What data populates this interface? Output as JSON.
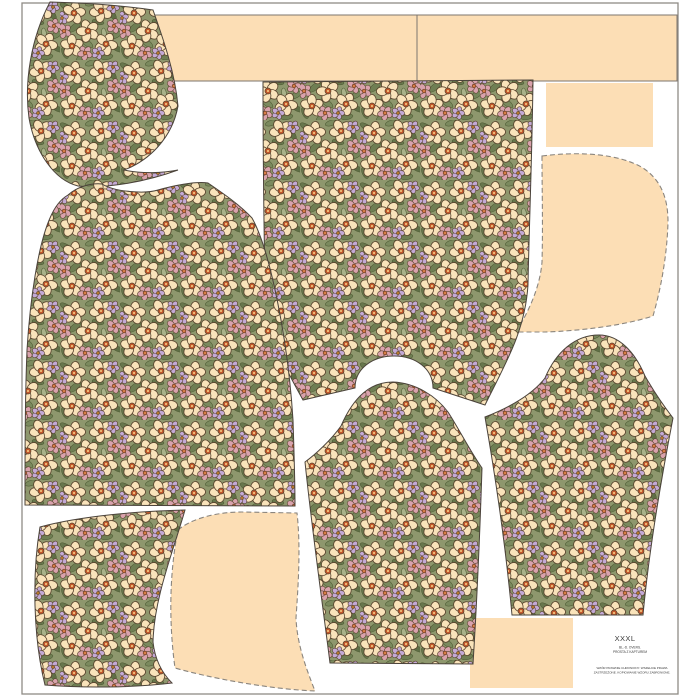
{
  "label_block": {
    "size": "XXXL",
    "style_line1": "BL.-D. OVERS.",
    "style_line2": "PROSTA Z KAPTUREM",
    "legal_line1": "WZÓR PRAWNIE CHRONIONY. WSZELKIE PRAWA",
    "legal_line2": "ZASTRZEŻONE. KOPIOWANIE WZORU ZABRONIONE."
  },
  "colors": {
    "background": "#ffffff",
    "solid_piece_fill": "#fcdeb5",
    "frame_stroke": "#8f8b85",
    "strip_stroke": "#7c766e",
    "piece_outline": "#4b433a",
    "dashed_outline": "#8a857e",
    "fabric": {
      "base_green": "#8e976d",
      "leaf_dark": "#67764c",
      "leaf_light": "#a8b189",
      "flower_cream": "#f9e3ba",
      "flower_pink": "#d9a2ac",
      "flower_lilac": "#c3a9d5",
      "flower_center_orange": "#c2572a",
      "flower_outline_brown": "#58422c"
    }
  },
  "pieces": [
    {
      "id": "hood-top-left",
      "fill": "floral"
    },
    {
      "id": "strip-top-left",
      "fill": "solid-peach"
    },
    {
      "id": "strip-top-right",
      "fill": "solid-peach"
    },
    {
      "id": "rect-top-right",
      "fill": "solid-peach"
    },
    {
      "id": "hood-right",
      "fill": "solid-peach",
      "outline": "dashed"
    },
    {
      "id": "back-body",
      "fill": "floral"
    },
    {
      "id": "front-body",
      "fill": "floral"
    },
    {
      "id": "sleeve-center",
      "fill": "floral"
    },
    {
      "id": "sleeve-right",
      "fill": "floral"
    },
    {
      "id": "hood-bottom-left",
      "fill": "floral"
    },
    {
      "id": "hood-bottom-center",
      "fill": "solid-peach",
      "outline": "dashed"
    },
    {
      "id": "rect-bottom-right",
      "fill": "solid-peach"
    }
  ]
}
